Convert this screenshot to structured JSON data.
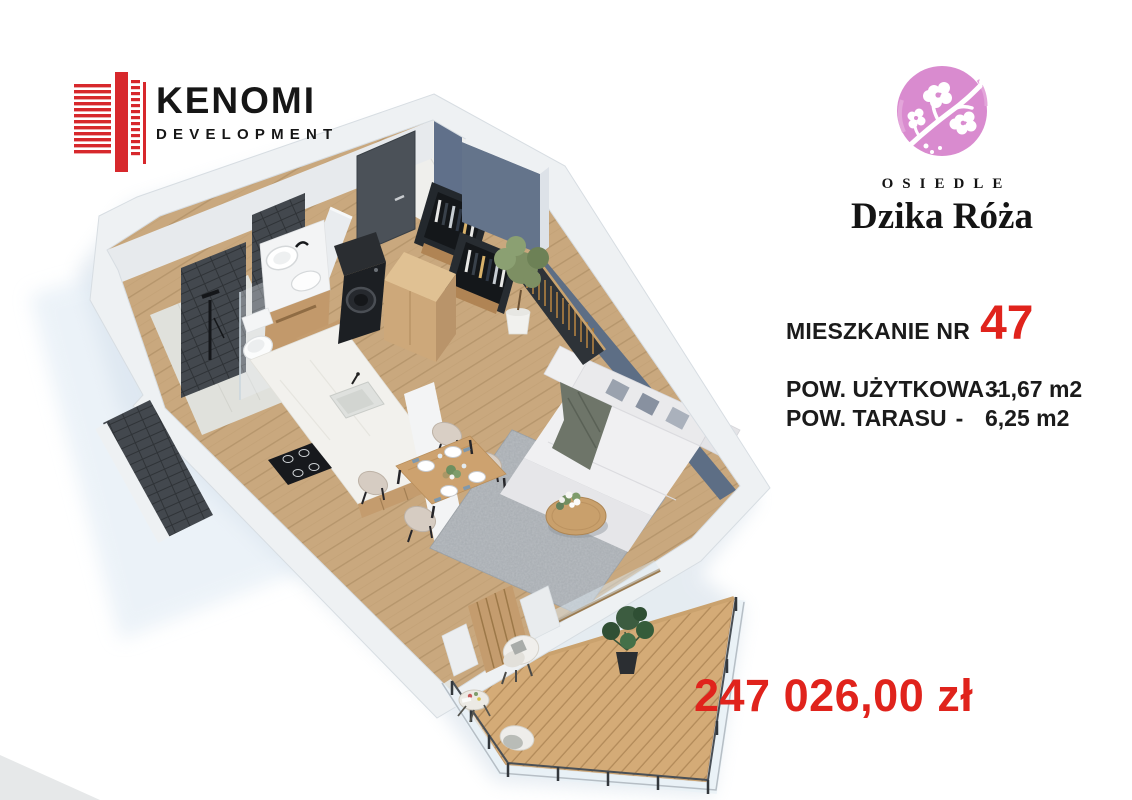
{
  "developer_logo": {
    "name": "KENOMI",
    "subtitle": "DEVELOPMENT"
  },
  "estate_logo": {
    "kicker": "OSIEDLE",
    "name": "Dzika Róża"
  },
  "listing": {
    "unit_label": "MIESZKANIE NR",
    "unit_number": "47",
    "areas": [
      {
        "label": "POW. UŻYTKOWA",
        "separator": "-",
        "value": "31,67 m2"
      },
      {
        "label": "POW. TARASU",
        "separator": "-",
        "value": "6,25 m2"
      }
    ],
    "price": "247 026,00 zł"
  },
  "palette": {
    "accent_red": "#e0231c",
    "logo_red": "#d7282c",
    "estate_pink": "#d98bcf",
    "accent_wall_blue": "#5d6e85",
    "wood_floor": "#c9a87e",
    "deck_wood": "#d4ab77",
    "text_black": "#1b1b1b"
  }
}
